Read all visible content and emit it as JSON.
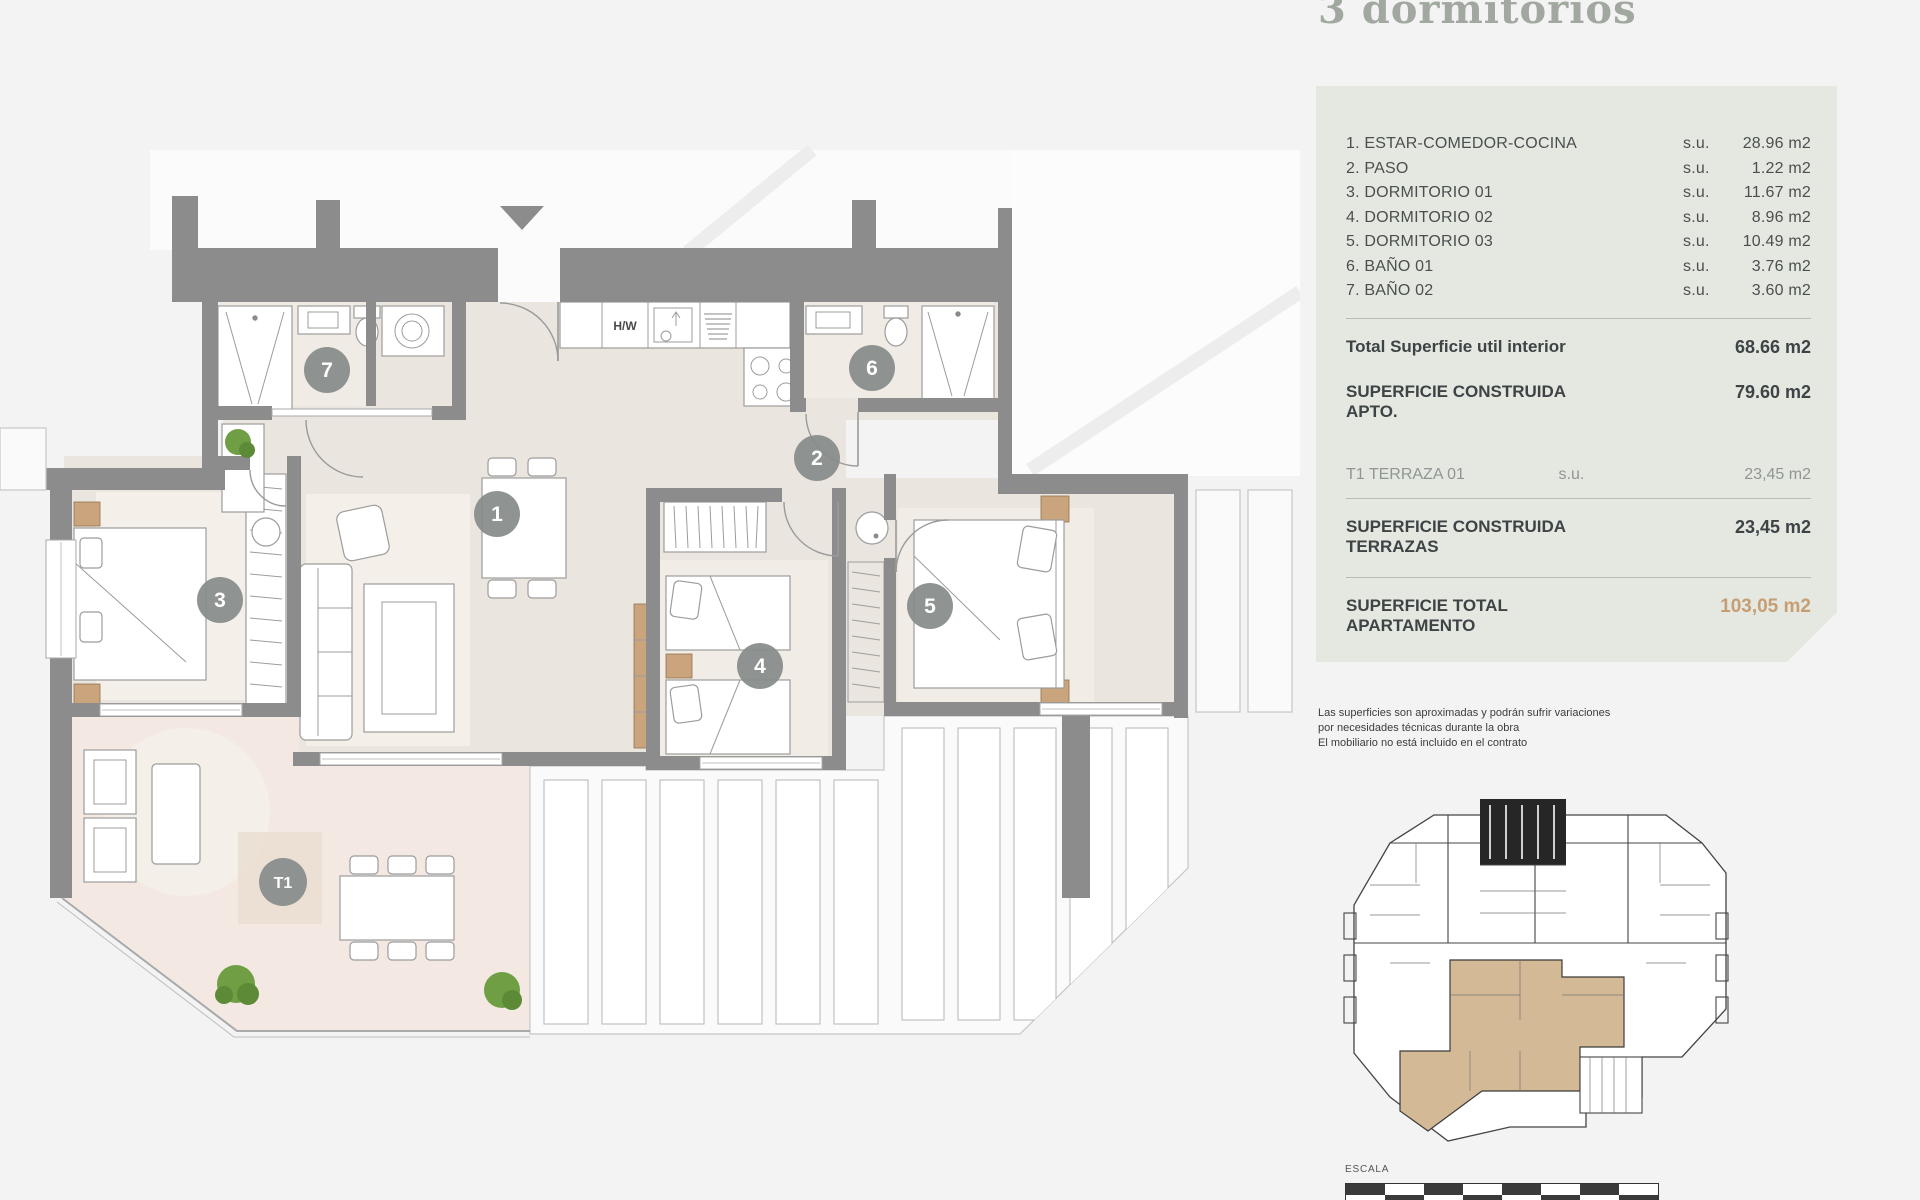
{
  "title": "3 dormitorios",
  "colors": {
    "accent": "#c79d72",
    "wall": "#8c8c8c",
    "floor_interior": "#ebe5df",
    "floor_terrace": "#f3e9e2",
    "badge": "#868c8b",
    "panel_bg": "#e4e8e1",
    "keyplan_highlight": "#d3b996"
  },
  "panel": {
    "rooms": [
      {
        "name": "1. ESTAR-COMEDOR-COCINA",
        "su": "s.u.",
        "value": "28.96 m2"
      },
      {
        "name": "2. PASO",
        "su": "s.u.",
        "value": "1.22 m2"
      },
      {
        "name": "3. DORMITORIO 01",
        "su": "s.u.",
        "value": "11.67 m2"
      },
      {
        "name": "4. DORMITORIO 02",
        "su": "s.u.",
        "value": "8.96 m2"
      },
      {
        "name": "5. DORMITORIO 03",
        "su": "s.u.",
        "value": "10.49 m2"
      },
      {
        "name": "6. BAÑO 01",
        "su": "s.u.",
        "value": "3.76 m2"
      },
      {
        "name": "7. BAÑO 02",
        "su": "s.u.",
        "value": "3.60 m2"
      }
    ],
    "totals": {
      "util": {
        "label": "Total Superficie util interior",
        "value": "68.66 m2"
      },
      "construida_apto": {
        "label": "SUPERFICIE CONSTRUIDA APTO.",
        "value": "79.60 m2"
      },
      "terraza": {
        "label": "T1 TERRAZA 01",
        "su": "s.u.",
        "value": "23,45 m2"
      },
      "construida_terrazas": {
        "label": "SUPERFICIE CONSTRUIDA TERRAZAS",
        "value": "23,45 m2"
      },
      "total_apartamento": {
        "label": "SUPERFICIE TOTAL APARTAMENTO",
        "value": "103,05 m2"
      }
    }
  },
  "disclaimer": [
    "Las superficies son aproximadas y podrán sufrir variaciones",
    "por necesidades técnicas durante la obra",
    "El mobiliario no está incluido en el contrato"
  ],
  "keyplan": {
    "escala_label": "ESCALA"
  },
  "plan": {
    "kitchen_appliance_label": "H/W",
    "badges": [
      {
        "label": "1"
      },
      {
        "label": "2"
      },
      {
        "label": "3"
      },
      {
        "label": "4"
      },
      {
        "label": "5"
      },
      {
        "label": "6"
      },
      {
        "label": "7"
      },
      {
        "label": "T1"
      }
    ]
  }
}
